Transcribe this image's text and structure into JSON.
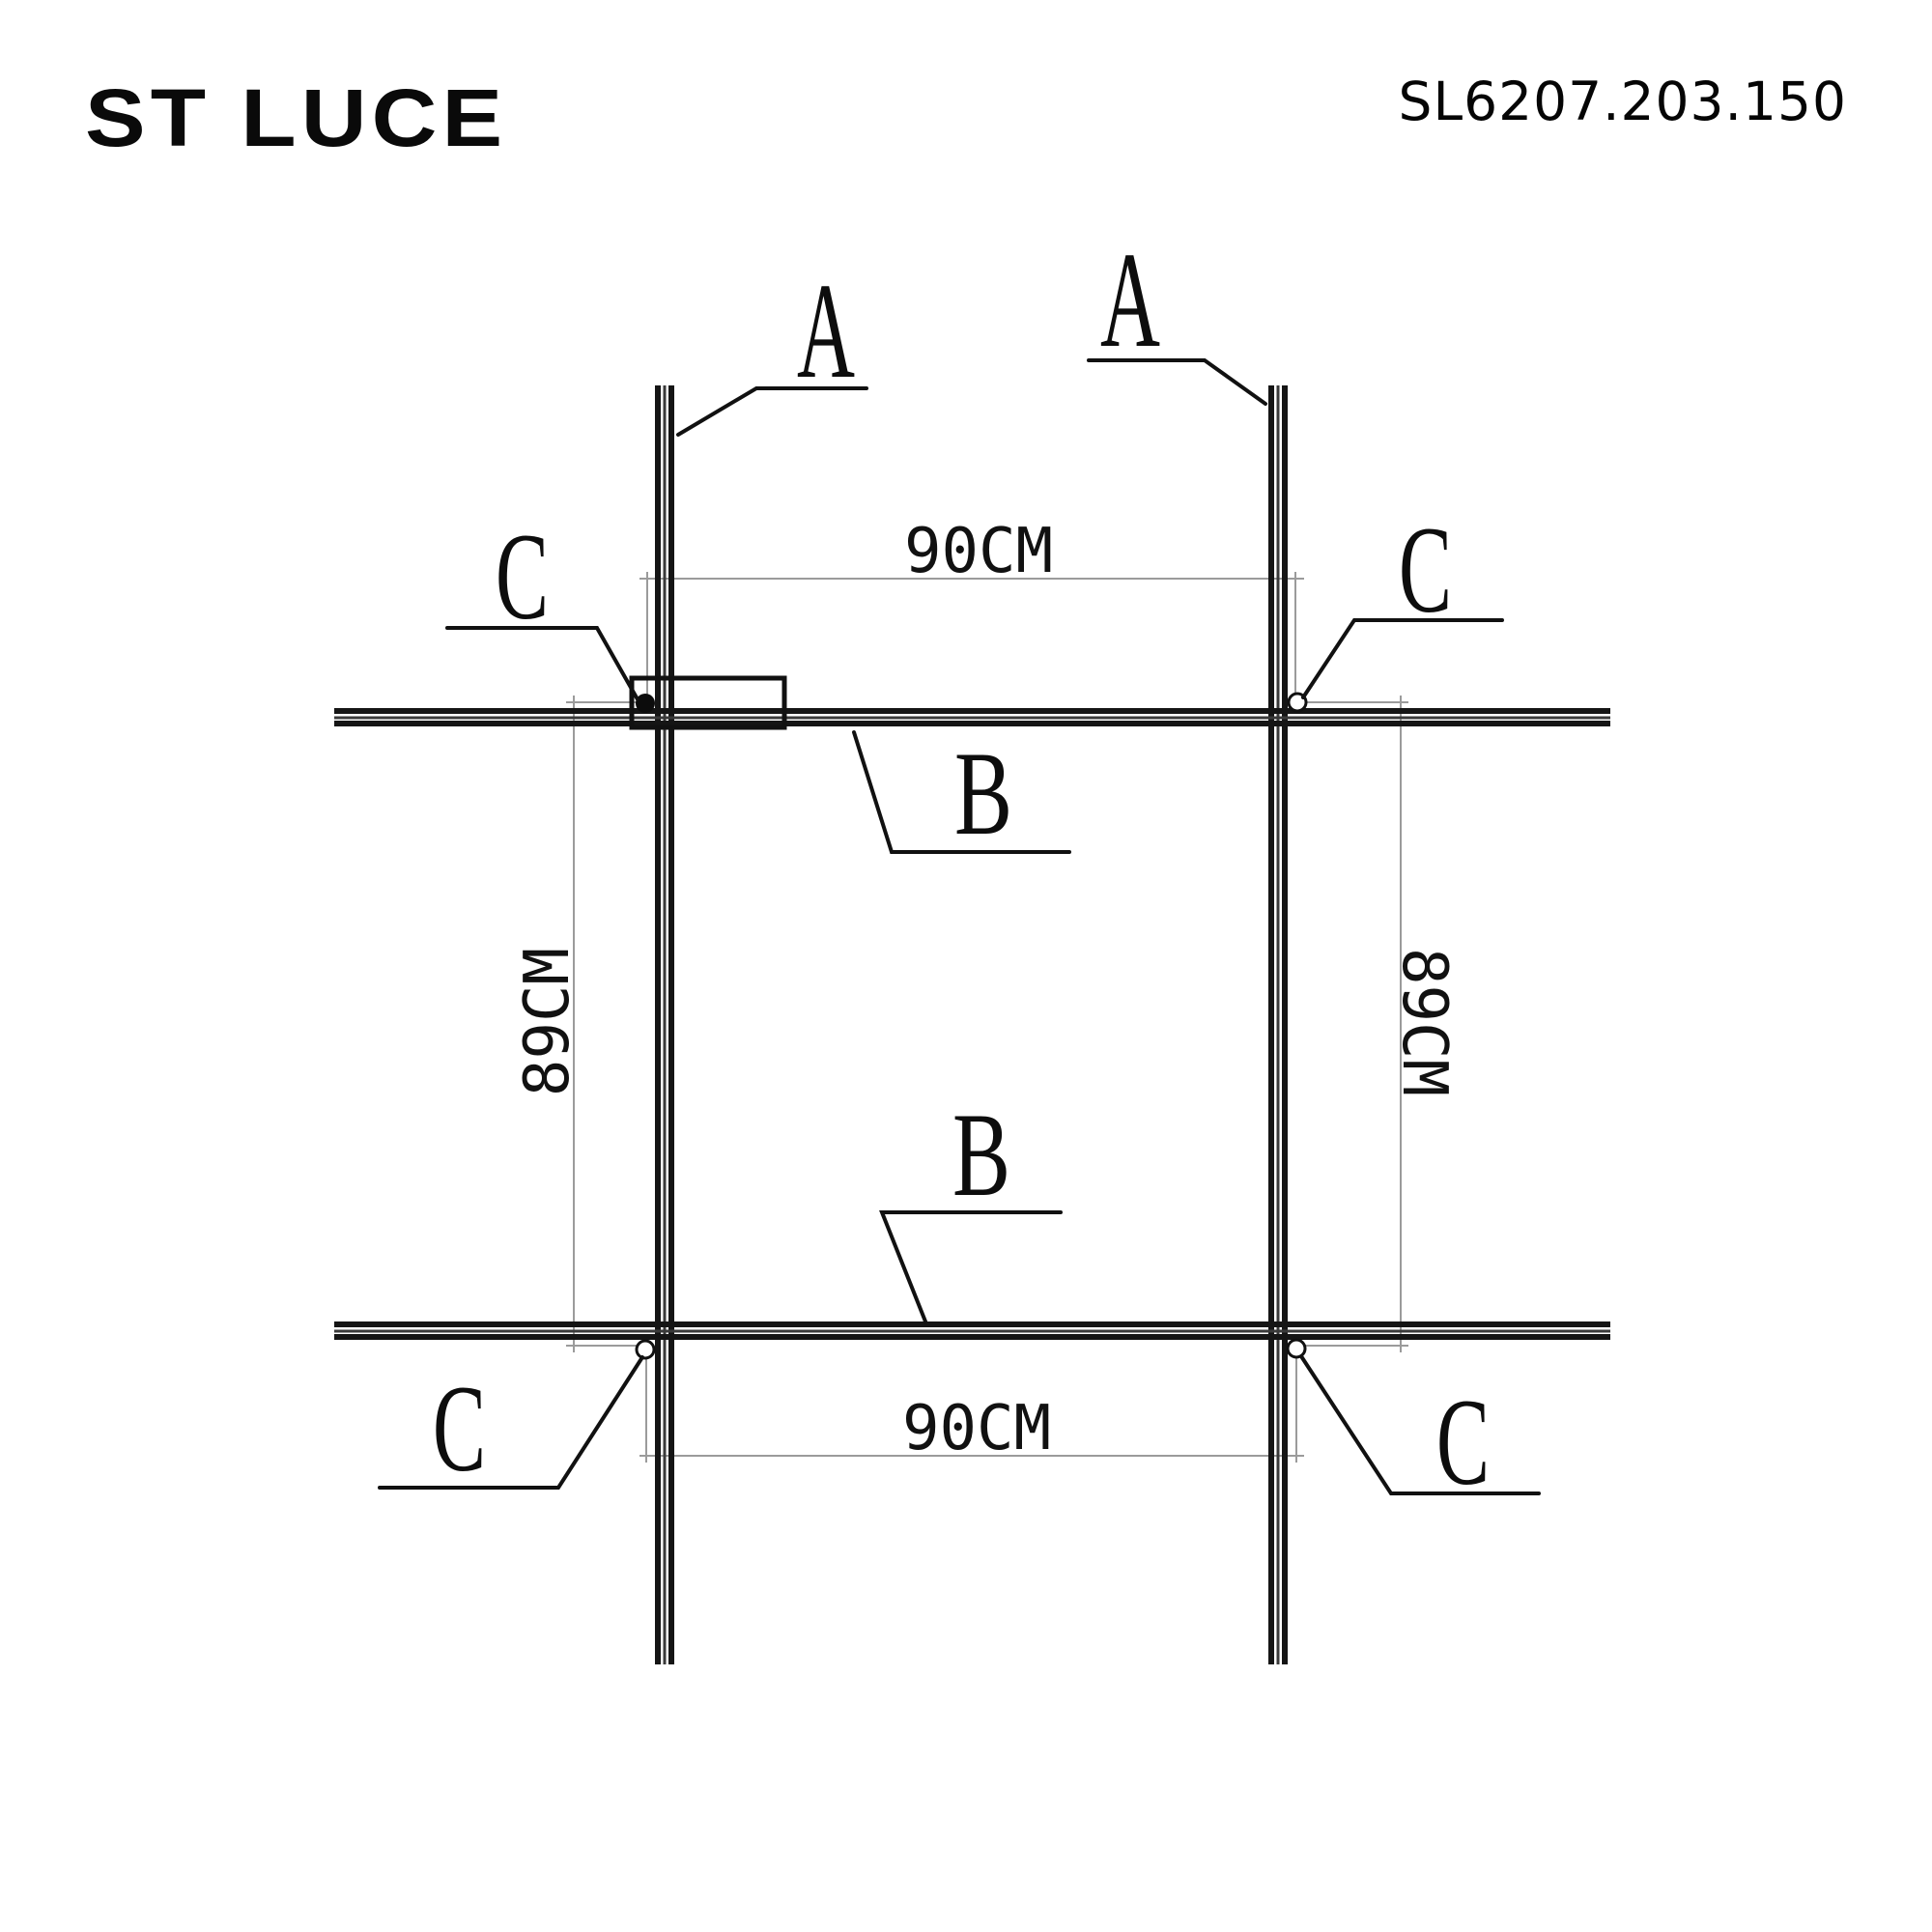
{
  "header": {
    "logo": "ST LUCE",
    "product_code": "SL6207.203.150"
  },
  "diagram": {
    "labels": {
      "a_left": "A",
      "a_right": "A",
      "b_top": "B",
      "b_bottom": "B",
      "c_top_left": "C",
      "c_top_right": "C",
      "c_bottom_left": "C",
      "c_bottom_right": "C"
    },
    "dimensions": {
      "width_top": "90CM",
      "width_bottom": "90CM",
      "height_left": "89CM",
      "height_right": "89CM"
    },
    "colors": {
      "line": "#111111",
      "dimension_line": "#9b9b9b"
    }
  }
}
